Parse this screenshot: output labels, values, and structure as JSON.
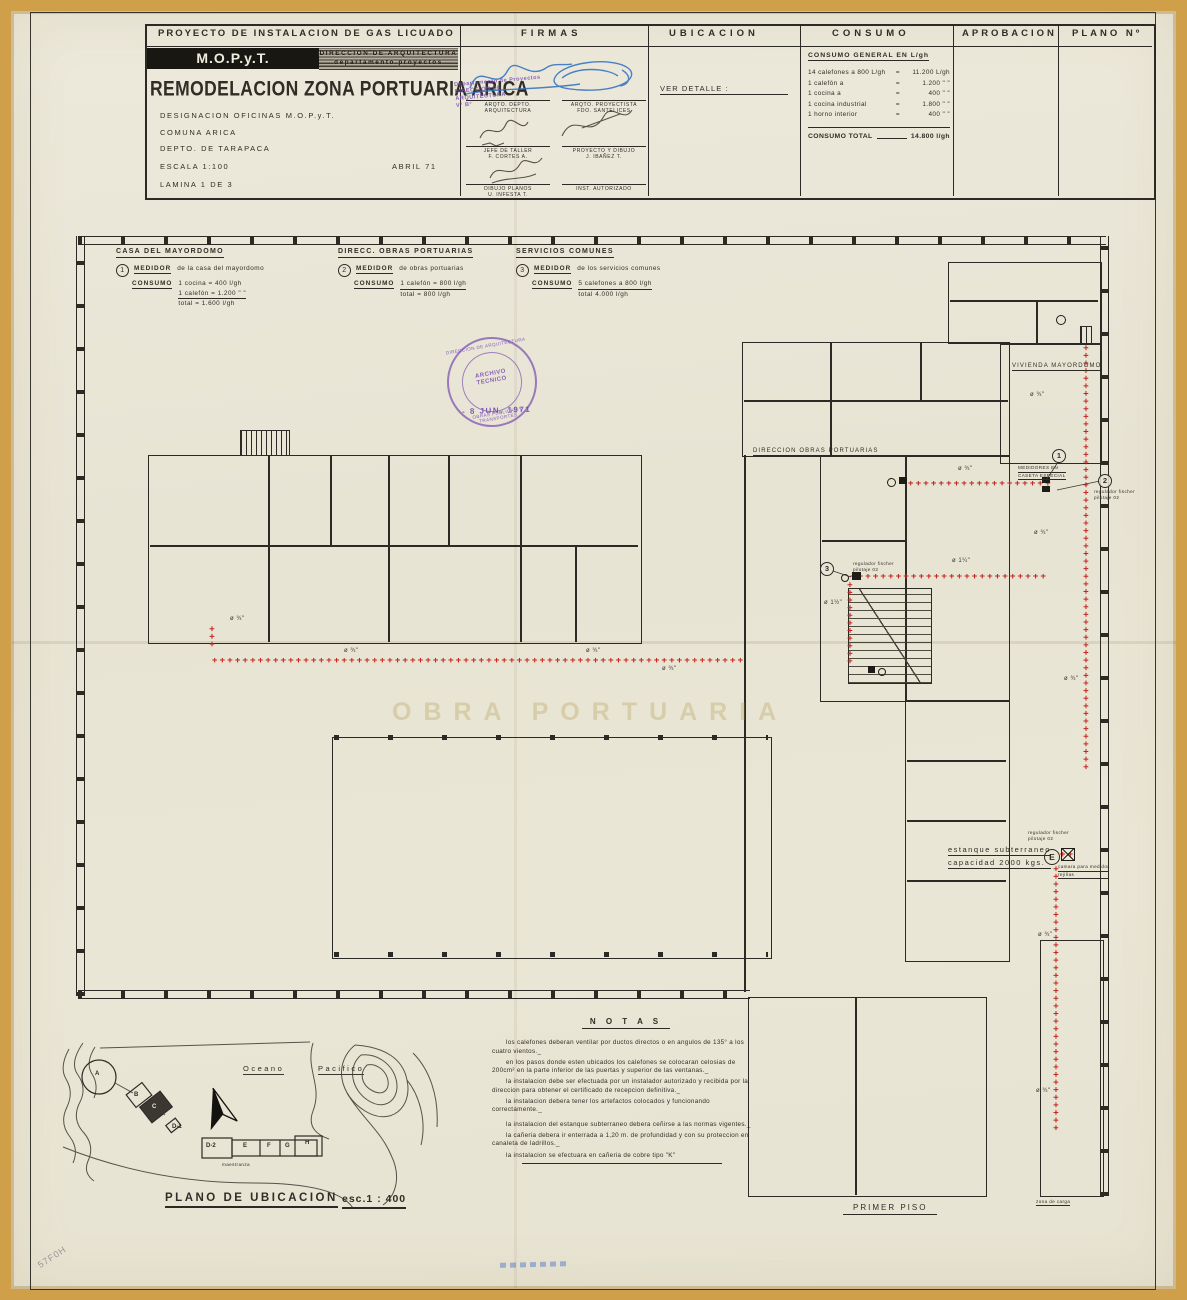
{
  "colors": {
    "paper": "#e9e6d7",
    "frame": "#cf9f4a",
    "ink": "#2c2a24",
    "pipe_red": "#c2251d",
    "stamp_purple": "#764ab0",
    "signature_blue": "#2e6fc0"
  },
  "title_block": {
    "project_header": "PROYECTO  DE  INSTALACION  DE  GAS  LICUADO",
    "columns": {
      "firmas": "FIRMAS",
      "ubicacion": "UBICACION",
      "consumo": "CONSUMO",
      "aprobacion": "APROBACION",
      "plano_no": "PLANO Nº"
    },
    "org": "M.O.P.y.T.",
    "direccion_line1": "DIRECCION  DE  ARQUITECTURA",
    "direccion_line2": "departamento   proyectos",
    "main_title": "REMODELACION ZONA PORTUARIA ARICA",
    "designacion": "DESIGNACION   OFICINAS  M.O.P.y.T.",
    "comuna": "COMUNA   ARICA",
    "depto": "DEPTO. DE TARAPACA",
    "escala": "ESCALA   1:100",
    "fecha": "ABRIL   71",
    "lamina": "LAMINA   1   DE   3",
    "ubicacion_note": "VER   DETALLE :"
  },
  "firmas": {
    "roles": [
      {
        "role": "ARQTO. DEPTO. ARQUITECTURA",
        "name": ""
      },
      {
        "role": "ARQTO. PROYECTISTA",
        "name": "FDO. SANTELICES"
      },
      {
        "role": "JEFE DE TALLER",
        "name": "F. CORTES A."
      },
      {
        "role": "PROYECTO Y DIBUJO",
        "name": "J. IBAÑEZ T."
      },
      {
        "role": "DIBUJO PLANOS",
        "name": "U. INFESTA T."
      },
      {
        "role": "INST. AUTORIZADO",
        "name": ""
      }
    ],
    "stamp_line1": "Departamento  de  Proyectos",
    "stamp_line2": "DIRECCION DE ARQUITECTURA",
    "stamp_line3": "V° B°"
  },
  "consumo": {
    "title": "CONSUMO  GENERAL  EN   L/gh",
    "rows": [
      {
        "item": "14 calefones a 800 L/gh",
        "eq": "=",
        "value": "11.200 L/gh"
      },
      {
        "item": "1 calefón    a",
        "eq": "=",
        "value": "1.200 \" \""
      },
      {
        "item": "1 cocina       a",
        "eq": "=",
        "value": "400 \" \""
      },
      {
        "item": "1 cocina  industrial",
        "eq": "=",
        "value": "1.800 \" \""
      },
      {
        "item": "1 horno  interior",
        "eq": "=",
        "value": "400 \" \""
      }
    ],
    "total_label": "CONSUMO   TOTAL",
    "total_value": "14.800 l/gh"
  },
  "meters": [
    {
      "heading": "CASA  DEL  MAYORDOMO",
      "num": "1",
      "medidor": "MEDIDOR",
      "desc": "de  la  casa  del  mayordomo",
      "consumo_label": "CONSUMO",
      "lines": [
        "1 cocina  =  400 l/gh",
        "1 calefón = 1.200  \" \"",
        "total  =  1.600  l/gh"
      ]
    },
    {
      "heading": "DIRECC.  OBRAS  PORTUARIAS",
      "num": "2",
      "medidor": "MEDIDOR",
      "desc": "de  obras  portuarias",
      "consumo_label": "CONSUMO",
      "lines": [
        "1 calefón  =  800  l/gh",
        "total     =     800  l/gh"
      ]
    },
    {
      "heading": "SERVICIOS   COMUNES",
      "num": "3",
      "medidor": "MEDIDOR",
      "desc": "de  los  servicios  comunes",
      "consumo_label": "CONSUMO",
      "lines": [
        "5 calefones  a  800  l/gh",
        "total          4.000  l/gh"
      ]
    }
  ],
  "stamp": {
    "ring_top": "DIRECCION DE ARQUITECTURA",
    "ring_bottom": "OBRAS PUBLICAS Y TRANSPORTES",
    "center1": "ARCHIVO",
    "center2": "TECNICO",
    "date": "- 8 JUN. 1971"
  },
  "plan_labels": {
    "vivienda_mayordomo": "VIVIENDA  MAYORDOMO",
    "direccion_obras": "DIRECCION   OBRAS   PORTUARIAS",
    "medidores_caseta_1": "MEDIDORES  EN",
    "medidores_caseta_2": "CASETA  ESPECIAL",
    "regulador_a": "regulador  fischer",
    "regulador_b": "pilotaje  02",
    "estanque_1": "estanque   subterraneo",
    "estanque_2": "capacidad  2000  kgs.",
    "letter_e": "E",
    "camara_1": "camara  para  medidor",
    "camara_2": "rejillas",
    "primer_piso": "PRIMER   PISO",
    "zona_carga": "zona  de  carga",
    "watermark": "OBRA  PORTUARIA",
    "m1": "1",
    "m2": "2",
    "m3": "3"
  },
  "pipe_labels": [
    {
      "t": "ø ¾\"",
      "x": 230,
      "y": 616
    },
    {
      "t": "ø ¾\"",
      "x": 344,
      "y": 648
    },
    {
      "t": "ø ¾\"",
      "x": 586,
      "y": 648
    },
    {
      "t": "ø ¾\"",
      "x": 662,
      "y": 666
    },
    {
      "t": "ø ¾\"",
      "x": 1030,
      "y": 392
    },
    {
      "t": "ø ¾\"",
      "x": 958,
      "y": 466
    },
    {
      "t": "ø 1¼\"",
      "x": 952,
      "y": 558
    },
    {
      "t": "ø ¾\"",
      "x": 1034,
      "y": 530
    },
    {
      "t": "ø ¾\"",
      "x": 1064,
      "y": 676
    },
    {
      "t": "ø ¾\"",
      "x": 1038,
      "y": 932
    },
    {
      "t": "ø ¾\"",
      "x": 1036,
      "y": 1088
    },
    {
      "t": "ø 1½\"",
      "x": 824,
      "y": 600
    }
  ],
  "map": {
    "oceano": "Oceano",
    "pacifico": "Pacifico",
    "buildings": [
      "A",
      "B",
      "C",
      "D-1",
      "D-2",
      "E",
      "F",
      "G",
      "H"
    ],
    "maestranza": "maestranza",
    "caption": "PLANO  DE  UBICACION",
    "scale": "esc.1 : 400"
  },
  "notas": {
    "title": "N O T A S",
    "paragraphs": [
      "los calefones deberan ventilar por ductos directos o en angulos de 135° a los cuatro vientos._",
      "en los pasos donde esten ubicados los calefones se colocaran celosias de 200cm² en la parte inferior de las puertas y superior de las ventanas._",
      "la instalacion debe ser efectuada por un instalador autorizado y recibida por la direccion para obtener el certificado de recepcion definitiva._",
      "la instalacion debera tener los artefactos colocados y funcionando correctamente._",
      "la instalacion del estanque subterraneo debera ceñirse a las normas vigentes._",
      "la cañeria debera ir enterrada a 1,20 m. de profundidad y con su proteccion en canaleta de ladrillos._",
      "la instalacion se efectuara en cañeria de cobre tipo \"K\""
    ]
  },
  "pencil_mark": "57F0H"
}
